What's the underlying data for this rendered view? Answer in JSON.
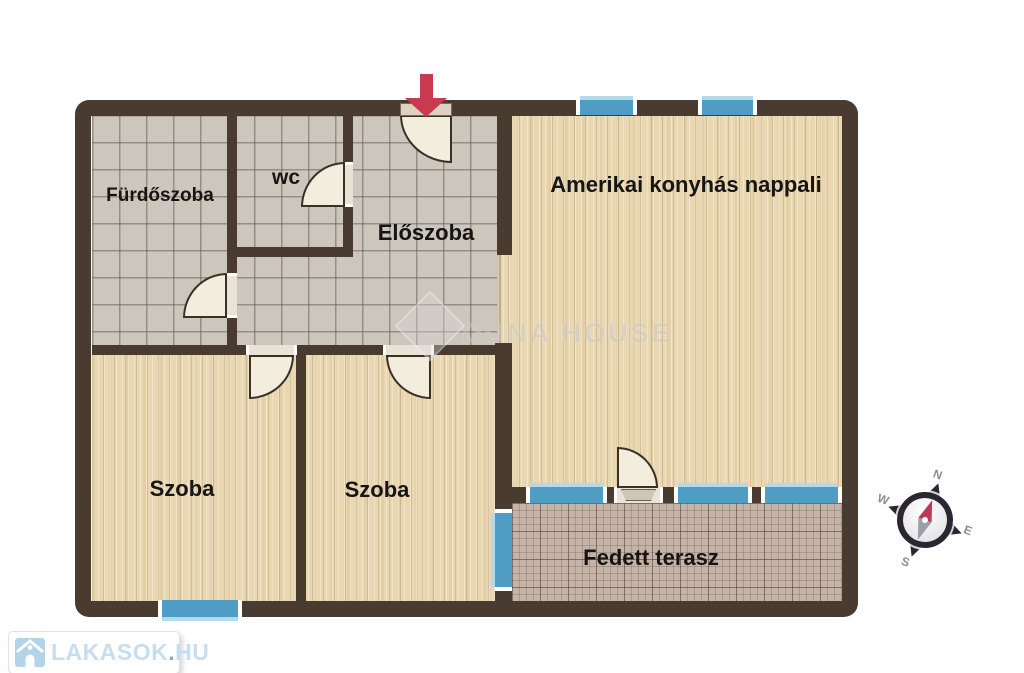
{
  "rooms": {
    "bathroom": {
      "label": "Fürdőszoba",
      "floor": "tile"
    },
    "wc": {
      "label": "wc",
      "floor": "tile"
    },
    "hall": {
      "label": "Előszoba",
      "floor": "tile"
    },
    "living": {
      "label": "Amerikai konyhás nappali",
      "floor": "wood"
    },
    "room1": {
      "label": "Szoba",
      "floor": "wood"
    },
    "room2": {
      "label": "Szoba",
      "floor": "wood"
    },
    "terrace": {
      "label": "Fedett terasz",
      "floor": "outdoor-tile"
    }
  },
  "compass": {
    "north": "N",
    "east": "E",
    "south": "S",
    "west": "W"
  },
  "watermark": {
    "brand": "DUNA HOUSE"
  },
  "branding": {
    "name": "LAKASOK",
    "dot": ".",
    "tld": "HU"
  },
  "icons": {
    "entrance_arrow": "down-arrow",
    "compass": "compass-rose",
    "logo_house": "house"
  },
  "colors": {
    "wall": "#4a3b30",
    "window_blue": "#4f9dc4",
    "window_light_edge": "#b5d9e9",
    "tile_floor": "#cdc6bc",
    "wood_floor": "#e9d7b2",
    "terrace_floor": "#c6b3a7",
    "door_fan": "#f3edde",
    "entrance_arrow": "#c9394f",
    "needle_north": "#b93a56",
    "needle_south": "#9aa0a4",
    "logo_blue": "#c5def0"
  }
}
